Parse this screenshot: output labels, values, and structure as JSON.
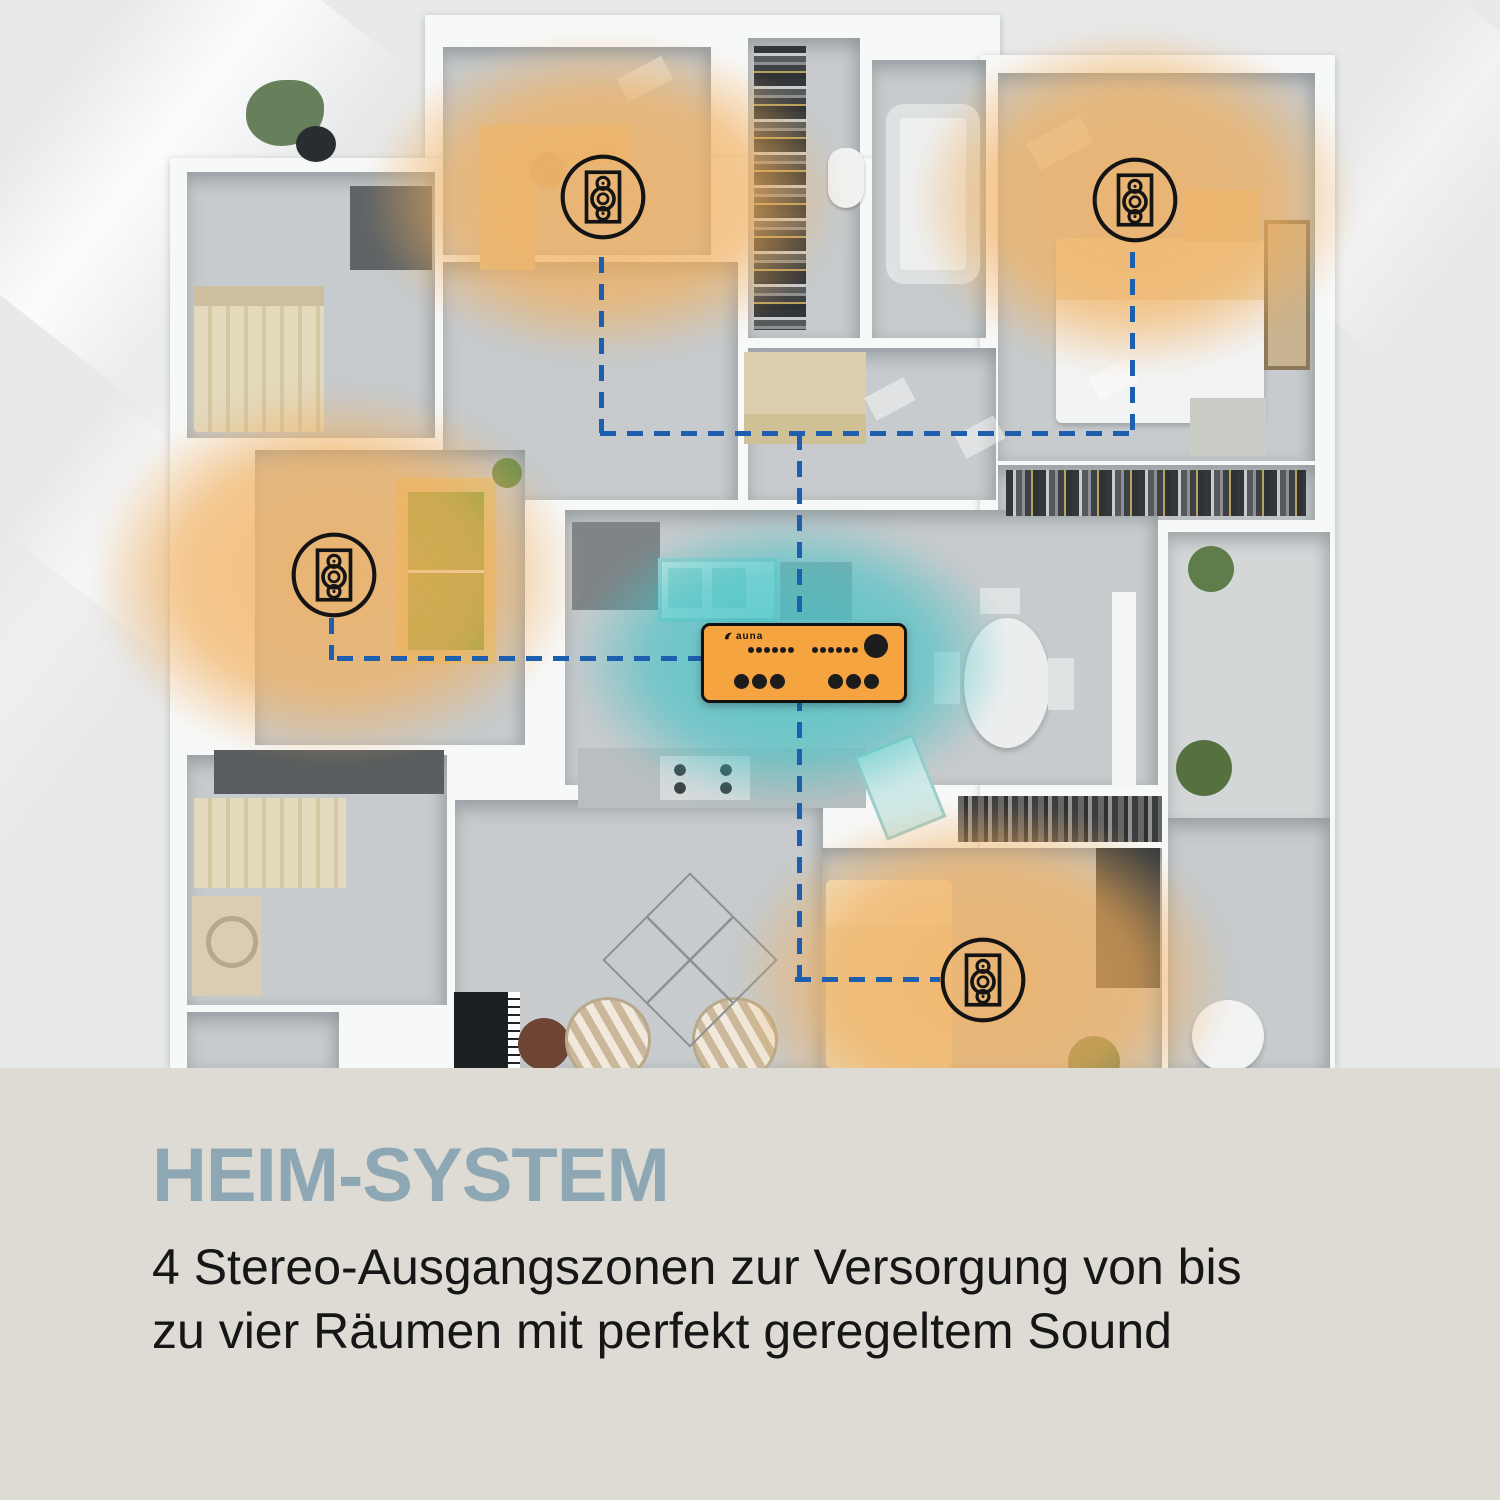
{
  "caption": {
    "title": "HEIM-SYSTEM",
    "line1": "4 Stereo-Ausgangszonen zur Versorgung von bis",
    "line2": "zu vier Räumen mit perfekt geregeltem Sound"
  },
  "colors": {
    "amp_orange": "#F6A43F",
    "connection_blue": "#1E5EAE",
    "teal_glow": "#3FC2C6",
    "orange_glow": "#F2AE5A",
    "heading_blue": "#8DA7B4",
    "band_background": "#DDDBD4",
    "body_text": "#161616",
    "icon_stroke": "#141414"
  },
  "diagram": {
    "type": "home-multiroom-audio-floorplan",
    "amplifier": {
      "brand": "auna",
      "x": 701,
      "y": 623,
      "w": 200,
      "h": 74,
      "glow": {
        "cx": 790,
        "cy": 660,
        "rx": 215,
        "ry": 145
      },
      "controls": {
        "small_dot_groups": [
          6,
          6
        ],
        "large_dot_groups": [
          3,
          3
        ],
        "knob_count": 1
      }
    },
    "zones": [
      {
        "id": "zone-1",
        "name": "speaker-zone-top-left",
        "cx": 603,
        "cy": 197,
        "glow": {
          "rx": 235,
          "ry": 160
        }
      },
      {
        "id": "zone-2",
        "name": "speaker-zone-top-right",
        "cx": 1135,
        "cy": 200,
        "glow": {
          "rx": 220,
          "ry": 170
        }
      },
      {
        "id": "zone-3",
        "name": "speaker-zone-mid-left",
        "cx": 334,
        "cy": 575,
        "glow": {
          "rx": 240,
          "ry": 185
        }
      },
      {
        "id": "zone-4",
        "name": "speaker-zone-bottom",
        "cx": 983,
        "cy": 980,
        "glow": {
          "rx": 245,
          "ry": 175
        }
      }
    ],
    "icon_radius": 44,
    "connections": [
      {
        "id": "bus-top",
        "x": 600,
        "y": 431,
        "len": 537,
        "dir": "h"
      },
      {
        "id": "drop-zone1",
        "x": 599,
        "y": 257,
        "len": 176,
        "dir": "v"
      },
      {
        "id": "drop-zone2",
        "x": 1130,
        "y": 252,
        "len": 181,
        "dir": "v"
      },
      {
        "id": "amp-up",
        "x": 797,
        "y": 434,
        "len": 191,
        "dir": "v"
      },
      {
        "id": "zone3-h",
        "x": 337,
        "y": 656,
        "len": 368,
        "dir": "h"
      },
      {
        "id": "zone3-stub",
        "x": 329,
        "y": 618,
        "len": 42,
        "dir": "v"
      },
      {
        "id": "amp-down",
        "x": 797,
        "y": 695,
        "len": 288,
        "dir": "v"
      },
      {
        "id": "zone4-h",
        "x": 795,
        "y": 977,
        "len": 145,
        "dir": "h"
      }
    ]
  }
}
